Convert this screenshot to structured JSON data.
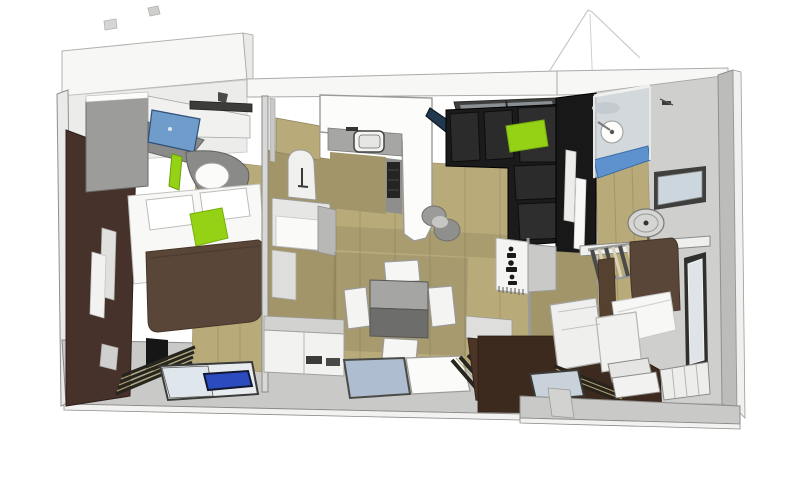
{
  "scene": {
    "label": "3D rendered top-down floor plan of a small two-bedroom mobile home",
    "background": "#ffffff"
  },
  "palette": {
    "wallWhite": "#f7f7f5",
    "wallLight": "#eaeae8",
    "wallGray": "#d3d3d1",
    "wallDark": "#bcbcba",
    "wallFaceGray": "#cfcfcd",
    "lampDark": "#3c3c3a",
    "floorWood": "#b9aa7a",
    "floorWoodDark": "#a3956a",
    "deckGray": "#c9c9c7",
    "accentGreen": "#95d216",
    "accentWallBrown": "#46322a",
    "duvetBrown": "#594639",
    "drapeBrown": "#55412f",
    "floorBrown": "#3d2a1e",
    "cabinetBrown": "#4c3527",
    "sofaBlack": "#1b1b1b",
    "sofaCushion": "#2b2b2b",
    "blackCube": "#161616",
    "blackWall": "#181818",
    "laptopBlue": "#6f9ccb",
    "tvNavy": "#22384f",
    "skylightFrame": "#3f3f3d",
    "skylightInner": "#8a8f94",
    "glassBlue": "#aebdd0",
    "glassPane": "#d3d9dd",
    "glassLight": "#dfe4e8",
    "showerTrayBlue": "#5e92cf",
    "tabletBlue": "#2b4bbf",
    "furnWhite": "#f4f4f2",
    "pureWhite": "#fcfcfb",
    "counterGray": "#a6a6a4",
    "counterDark": "#8e8e8c",
    "cooktopBlack": "#242424",
    "wardrobeGray": "#9c9c9a",
    "deskShellGray": "#8a8a88",
    "tableTop": "#a5a5a3",
    "tableFront": "#6d6d6b",
    "slatDark": "#26261e",
    "shadow": "rgba(90,85,60,0.18)"
  },
  "objects": {
    "left_bedroom": [
      "wardrobe",
      "laptop",
      "desk-chair",
      "double-bed",
      "green-cushion",
      "brown-duvet",
      "accent-wall",
      "bench-slats",
      "floor-glass",
      "tablet"
    ],
    "hallway": [
      "washbasin-arch",
      "basin-cabinet",
      "sliding-door-track"
    ],
    "kitchen": [
      "l-counter",
      "sink",
      "cooktop",
      "bar-stools",
      "tv-board"
    ],
    "living": [
      "skylight",
      "corner-sofa",
      "green-pillow",
      "patterned-divider"
    ],
    "dining": [
      "square-table",
      "chairs"
    ],
    "bathroom": [
      "black-partition",
      "towels",
      "shower-cabin",
      "shower-head",
      "shower-tray",
      "window"
    ],
    "right_bedroom": [
      "dish-fan",
      "wall-shelf",
      "ladder",
      "bunk-bed",
      "pillow",
      "blinds",
      "steps",
      "tall-window",
      "dark-floor"
    ]
  }
}
